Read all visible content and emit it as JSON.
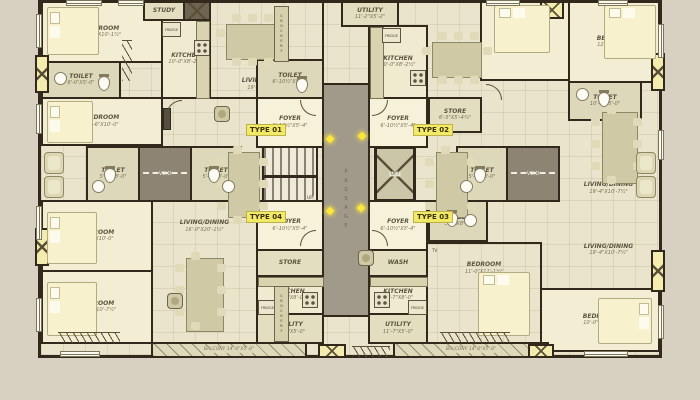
{
  "title": "Apartment cluster typical floor plan",
  "palette": {
    "background": "#d8d1c1",
    "floor": "#e9e4cb",
    "wall": "#32281c",
    "type_tag_bg": "#f2e967",
    "core_gray": "#a19a8a",
    "duct_yellow": "#f3ecae",
    "marker_yellow": "#ffe63a"
  },
  "unit_labels": {
    "t1": "TYPE 01",
    "t2": "TYPE 02",
    "t3": "TYPE 03",
    "t4": "TYPE 04"
  },
  "core": {
    "passage": "PASSAGE",
    "lift": "LIFT",
    "up": "UP",
    "void_l": "VOID",
    "void_r": "VOID"
  },
  "fixtures": {
    "fridge": "FRIDGE",
    "crockery": "CROCKERY",
    "tv": "TV"
  },
  "rooms": {
    "t1_bed_a": {
      "label": "BEDROOM",
      "dims": "10'-0\"X10'-1½\""
    },
    "t1_toilet_a": {
      "label": "TOILET",
      "dims": "8'-0\"X5'-0\""
    },
    "t1_bed_b": {
      "label": "BEDROOM",
      "dims": "10'-6\"X10'-0\""
    },
    "t1_kitchen": {
      "label": "KITCHEN",
      "dims": "10'-0\"X8'-2½\""
    },
    "t1_study": {
      "label": "STUDY",
      "dims": "6'-0\"X5'-0\""
    },
    "t1_living": {
      "label": "LIVING/DINING",
      "dims": "19'-4\"X10'-7½\""
    },
    "t1_toilet_b": {
      "label": "TOILET",
      "dims": "6'-10½\"X5'-4\""
    },
    "t1_foyer": {
      "label": "FOYER",
      "dims": "6'-10½\"X5'-4\""
    },
    "t2_utility": {
      "label": "UTILITY",
      "dims": "11'-2\"X5'-2\""
    },
    "t2_kitchen": {
      "label": "KITCHEN",
      "dims": "10'-0\"X8'-2½\""
    },
    "t2_store": {
      "label": "STORE",
      "dims": "6'-5\"X5'-4¼\""
    },
    "t2_foyer": {
      "label": "FOYER",
      "dims": "6'-10½\"X5'-4\""
    },
    "t2_bed_a": {
      "label": "BEDROOM",
      "dims": "10'-6\"X10'-0\""
    },
    "t2_bed_b": {
      "label": "BEDROOM",
      "dims": "12'-0\"X10'-0\""
    },
    "t2_toilet": {
      "label": "TOILET",
      "dims": "10'-1\"X5'-0\""
    },
    "t2_living": {
      "label": "LIVING/DINING",
      "dims": "19'-4\"X10'-7½\""
    },
    "mid_toilet_l1": {
      "label": "TOILET",
      "dims": "5'-2\"X8'-0\""
    },
    "mid_toilet_l2": {
      "label": "TOILET",
      "dims": "5'-2\"X8'-0\""
    },
    "mid_toilet_r1": {
      "label": "TOILET",
      "dims": "5'-2\"X8'-0\""
    },
    "t4_bed_a": {
      "label": "BEDROOM",
      "dims": "10'-6\"X10'-0\""
    },
    "t4_bed_b": {
      "label": "BEDROOM",
      "dims": "10'-0\"X10'-7½\""
    },
    "t4_living": {
      "label": "LIVING/DINING",
      "dims": "16'-0\"X20'-1½\""
    },
    "t4_foyer": {
      "label": "FOYER",
      "dims": "6'-10½\"X5'-4\""
    },
    "t4_store": {
      "label": "STORE",
      "dims": "6'-5\"X5'-4¼\""
    },
    "t4_kitchen": {
      "label": "KITCHEN",
      "dims": "11'-7\"X8'-0\""
    },
    "t4_utility": {
      "label": "UTILITY",
      "dims": "11'-7\"X5'-0\""
    },
    "t4_balcony": {
      "label": "BALCONY",
      "dims": "14'-0\"X5'-0\""
    },
    "t3_foyer": {
      "label": "FOYER",
      "dims": "6'-10½\"X5'-4\""
    },
    "t3_toilet": {
      "label": "TOILET",
      "dims": "5'-2\"X8'-0\""
    },
    "t3_wash": {
      "label": "WASH",
      "dims": ""
    },
    "t3_kitchen": {
      "label": "KITCHEN",
      "dims": "11'-7\"X8'-0\""
    },
    "t3_utility": {
      "label": "UTILITY",
      "dims": "11'-7\"X5'-0\""
    },
    "t3_bed_a": {
      "label": "BEDROOM",
      "dims": "11'-0\"X11'-1½\""
    },
    "t3_bed_b": {
      "label": "BEDROOM",
      "dims": "10'-0\"X10'-2\""
    },
    "t3_living": {
      "label": "LIVING/DINING",
      "dims": "19'-4\"X10'-7½\""
    },
    "t3_balcony": {
      "label": "BALCONY",
      "dims": "14'-0\"X5'-0\""
    }
  }
}
